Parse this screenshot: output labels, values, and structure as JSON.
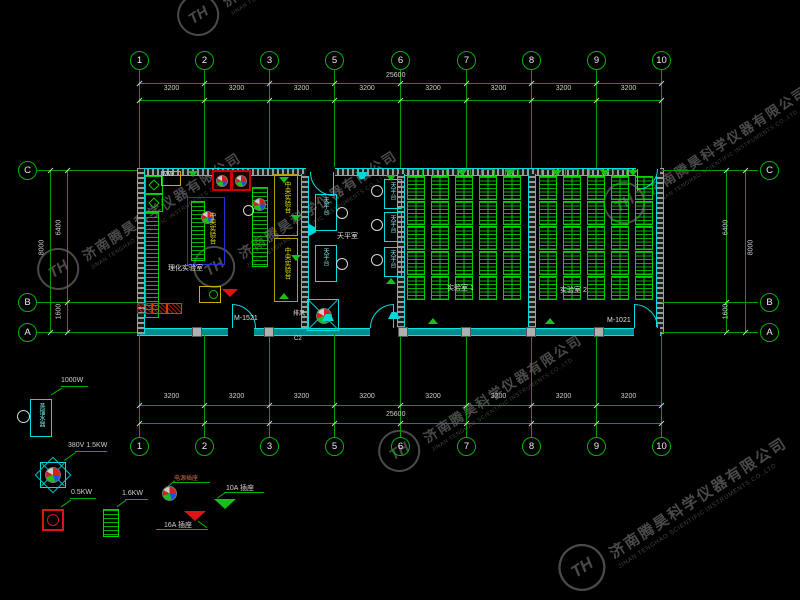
{
  "axes": {
    "top": {
      "bubbles": [
        "1",
        "2",
        "3",
        "5",
        "6",
        "7",
        "8",
        "9",
        "10"
      ],
      "dims": [
        "3200",
        "3200",
        "3200",
        "3200",
        "3200",
        "3200",
        "3200",
        "3200"
      ],
      "total": "25600"
    },
    "bottom": {
      "bubbles": [
        "1",
        "2",
        "3",
        "5",
        "6",
        "7",
        "8",
        "9",
        "10"
      ],
      "dims": [
        "3200",
        "3200",
        "3200",
        "3200",
        "3200",
        "3200",
        "3200",
        "3200"
      ],
      "total": "25600"
    },
    "left": {
      "bubbles": [
        "C",
        "B",
        "A"
      ],
      "span_cb": "6400",
      "span_ba": "1600",
      "total": "8000"
    },
    "right": {
      "bubbles": [
        "C",
        "B",
        "A"
      ],
      "span_cb": "6400",
      "span_ba": "1600",
      "total": "8000"
    }
  },
  "plan": {
    "room_labels": {
      "lab": "理化实验室",
      "prep": "天平室",
      "classroom1": "实验室 1",
      "classroom2": "实验室 2"
    },
    "bench_labels": {
      "central": "中央实验台",
      "balance": "天平台"
    },
    "tags": {
      "door_left": "M-1521",
      "door_right": "M-1021",
      "window": "C2",
      "exhaust": "排风",
      "hood": "MW"
    }
  },
  "legend": {
    "distiller": {
      "label": "蒸馏水器",
      "power": "1000W"
    },
    "exhaust_fan": {
      "power": "380V  1.5KW"
    },
    "pump": {
      "power": "0.5KW"
    },
    "heater": {
      "power": "1.6KW"
    },
    "socket_main": {
      "label": "电源插座"
    },
    "socket_16a": {
      "label": "16A 插座"
    },
    "socket_10a": {
      "label": "10A 插座"
    }
  },
  "watermark": {
    "cn": "济南腾昊科学仪器有限公司",
    "en": "JINAN TENGHAO SCIENTIFIC INSTRUMENTS CO.,LTD",
    "logo": "TH"
  },
  "colors": {
    "grid_green": "#00a800",
    "bench_green": "#00d400",
    "wall_cyan": "#00dede",
    "dim_text": "#d4d4d4",
    "accent_yellow": "#c8b400",
    "accent_blue": "#2830d8",
    "accent_red": "#dc1414",
    "watermark_gray": "#4a4a4a"
  }
}
